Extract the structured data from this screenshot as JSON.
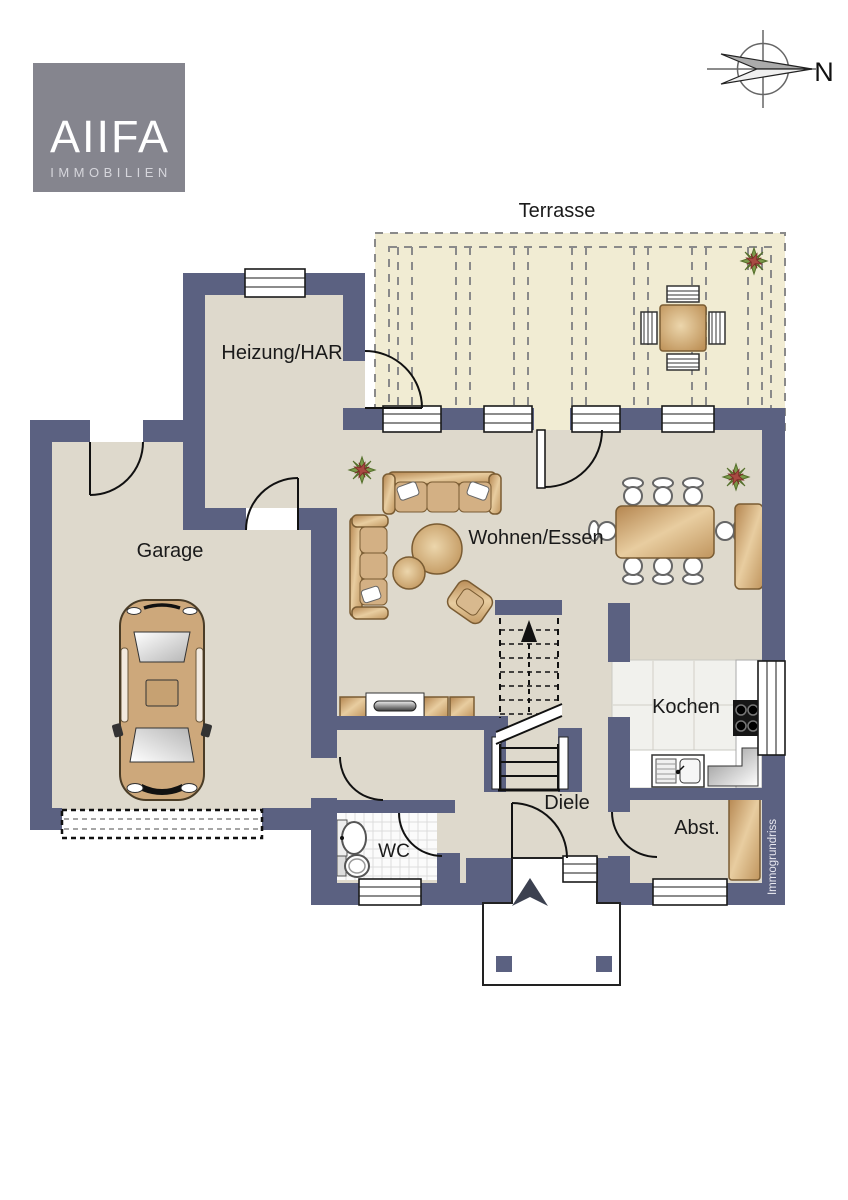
{
  "logo": {
    "brand": "AIIFA",
    "tagline": "IMMOBILIEN",
    "bg_color": "#85858e"
  },
  "compass": {
    "north_label": "N"
  },
  "rooms": {
    "terrace": "Terrasse",
    "heating": "Heizung/HAR",
    "garage": "Garage",
    "living": "Wohnen/Essen",
    "kitchen": "Kochen",
    "hall": "Diele",
    "wc": "WC",
    "storage": "Abst."
  },
  "watermark": "Immogrundriss",
  "colors": {
    "wall": "#5b6181",
    "floor": "#ded9cc",
    "terrace": "#f1ecd3",
    "label": "#1a1a1a",
    "wood": "#c9a06a",
    "logo_bg": "#85858e",
    "plant_green": "#7c9a4a",
    "plant_red": "#a84a42"
  }
}
